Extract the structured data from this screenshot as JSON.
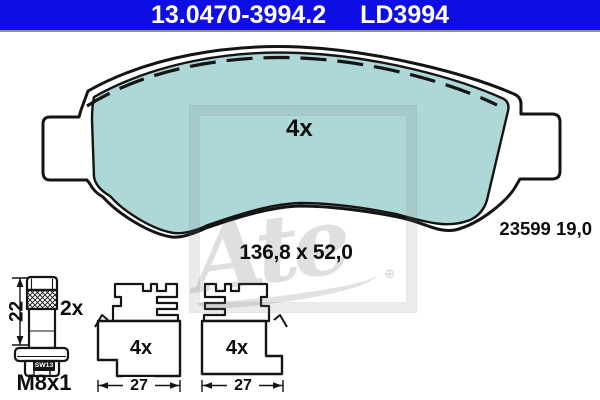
{
  "header": {
    "part_number": "13.0470-3994.2",
    "trade_code": "LD3994",
    "bg_color": "#0d0de4",
    "text_color": "#ffffff"
  },
  "pad": {
    "quantity": "4x",
    "dimensions": "136,8 x 52,0",
    "wva_thickness": "23599 19,0",
    "fill_color": "#aed7d7"
  },
  "bolt": {
    "quantity": "2x",
    "length": "22",
    "thread": "M8x1",
    "wrench_size": "SW13"
  },
  "clip_left": {
    "quantity": "4x",
    "width": "27"
  },
  "clip_right": {
    "quantity": "4x",
    "width": "27"
  },
  "watermark": {
    "logo_text": "Ate",
    "mark": "⊕"
  }
}
